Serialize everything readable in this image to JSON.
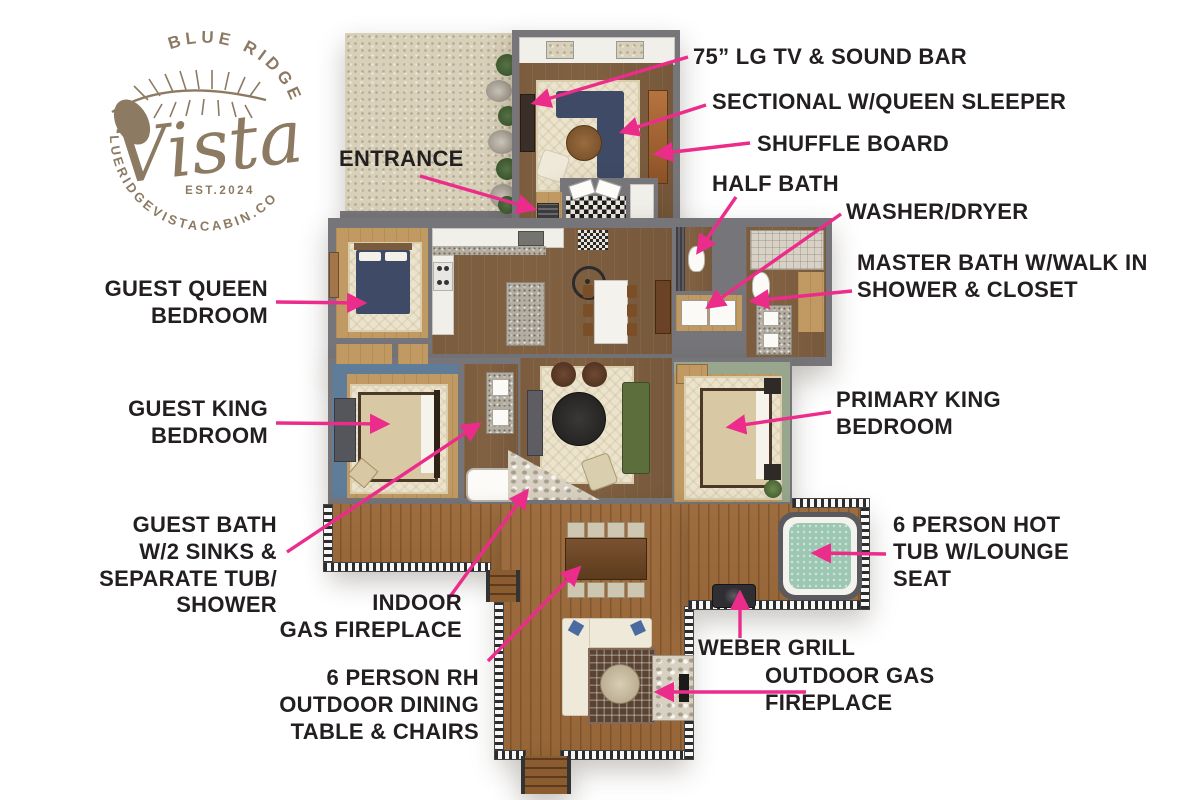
{
  "page": {
    "width": 1200,
    "height": 800,
    "background": "#ffffff"
  },
  "colors": {
    "arrow": "#ec2c8a",
    "label_text": "#231f20",
    "logo_brown": "#8c7a63",
    "wall_gray": "#76767a",
    "deck_wood": "#9a6a3c",
    "hot_tub_water": "#9cc7b2"
  },
  "logo": {
    "brand_line": "BLUE RIDGE",
    "brand_script": "Vista",
    "established": "EST.2024",
    "website": "BLUERIDGEVISTACABIN.COM"
  },
  "labels": {
    "tv": "75” LG TV & SOUND BAR",
    "sectional": "SECTIONAL W/QUEEN SLEEPER",
    "shuffleboard": "SHUFFLE BOARD",
    "half_bath": "HALF BATH",
    "washer_dryer": "WASHER/DRYER",
    "master_bath": "MASTER BATH W/WALK IN\nSHOWER & CLOSET",
    "entrance": "ENTRANCE",
    "guest_queen": "GUEST QUEEN\nBEDROOM",
    "guest_king": "GUEST KING\nBEDROOM",
    "primary_king": "PRIMARY KING\nBEDROOM",
    "guest_bath": "GUEST BATH\nW/2 SINKS &\nSEPARATE TUB/\nSHOWER",
    "indoor_fireplace": "INDOOR\nGAS FIREPLACE",
    "outdoor_dining": "6 PERSON RH\nOUTDOOR DINING\nTABLE & CHAIRS",
    "weber_grill": "WEBER GRILL",
    "outdoor_fireplace": "OUTDOOR GAS\nFIREPLACE",
    "hot_tub": "6 PERSON HOT\nTUB W/LOUNGE\nSEAT"
  }
}
